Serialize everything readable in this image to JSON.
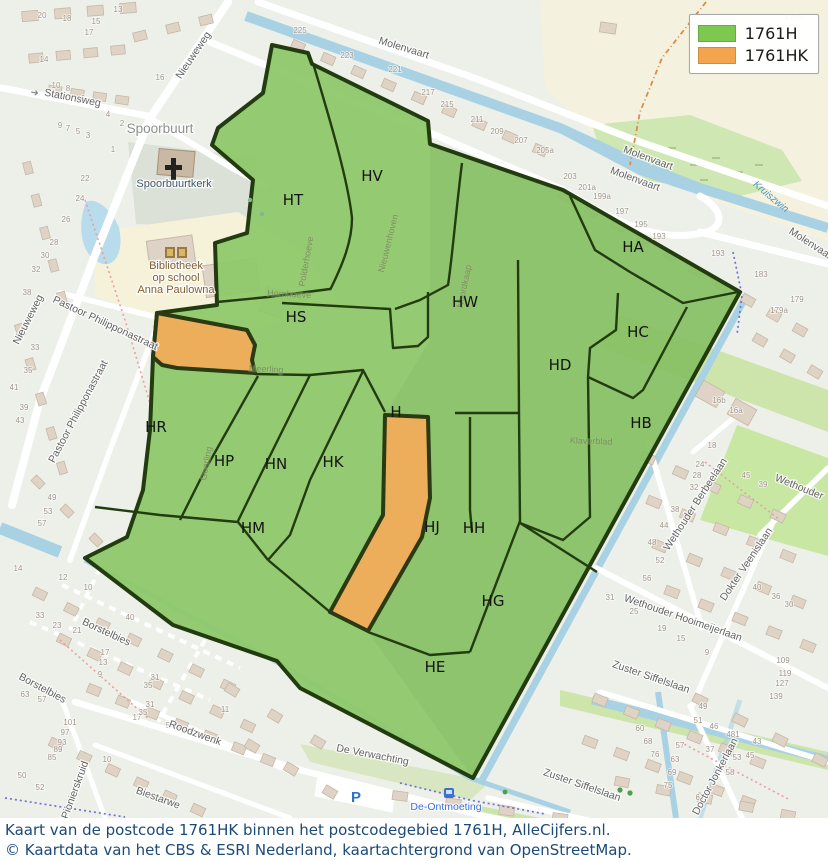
{
  "colors": {
    "area_1761h": "#8dc868",
    "area_1761hk": "#ecae5b",
    "boundary": "#223c10",
    "legend_green": "#7dc850",
    "legend_orange": "#f4a44c",
    "water": "#a8d2e4",
    "caption_text": "#1c4a78"
  },
  "legend": {
    "items": [
      {
        "label": "1761H",
        "color": "#7dc850"
      },
      {
        "label": "1761HK",
        "color": "#f4a44c"
      }
    ]
  },
  "caption": {
    "line1": "Kaart van de postcode 1761HK binnen het postcodegebied 1761H, AlleCijfers.nl.",
    "line2": "© Kaartdata van het CBS & ESRI Nederland, kaartachtergrond van OpenStreetMap."
  },
  "map": {
    "regions": [
      {
        "label": "HT",
        "x": 293,
        "y": 205
      },
      {
        "label": "HV",
        "x": 372,
        "y": 181
      },
      {
        "label": "HA",
        "x": 633,
        "y": 252
      },
      {
        "label": "HS",
        "x": 296,
        "y": 322
      },
      {
        "label": "HW",
        "x": 465,
        "y": 307
      },
      {
        "label": "HC",
        "x": 638,
        "y": 337
      },
      {
        "label": "HD",
        "x": 560,
        "y": 370
      },
      {
        "label": "HB",
        "x": 641,
        "y": 428
      },
      {
        "label": "HR",
        "x": 156,
        "y": 432
      },
      {
        "label": "HP",
        "x": 224,
        "y": 466
      },
      {
        "label": "HN",
        "x": 276,
        "y": 469
      },
      {
        "label": "HK",
        "x": 333,
        "y": 467
      },
      {
        "label": "HM",
        "x": 253,
        "y": 533
      },
      {
        "label": "H",
        "x": 396,
        "y": 417
      },
      {
        "label": "HJ",
        "x": 432,
        "y": 532
      },
      {
        "label": "HH",
        "x": 474,
        "y": 533
      },
      {
        "label": "HG",
        "x": 493,
        "y": 606
      },
      {
        "label": "HE",
        "x": 435,
        "y": 672
      }
    ],
    "streets": [
      {
        "label": "Nieuweweg",
        "x": 196,
        "y": 57,
        "rot": -56
      },
      {
        "label": "Stationsweg",
        "x": 72,
        "y": 101,
        "rot": 11
      },
      {
        "label": "Molenvaart",
        "x": 403,
        "y": 51,
        "rot": 17
      },
      {
        "label": "Molenvaart",
        "x": 647,
        "y": 161,
        "rot": 20
      },
      {
        "label": "Molenvaart",
        "x": 634,
        "y": 182,
        "rot": 20
      },
      {
        "label": "Molenvaart",
        "x": 810,
        "y": 247,
        "rot": 33
      },
      {
        "label": "Nieuweweg",
        "x": 31,
        "y": 321,
        "rot": -63
      },
      {
        "label": "Pastoor Philipponastraat",
        "x": 104,
        "y": 326,
        "rot": 25
      },
      {
        "label": "Pastoor Philipponastraat",
        "x": 81,
        "y": 413,
        "rot": -62
      },
      {
        "label": "Wethouder Berbeelaan",
        "x": 698,
        "y": 506,
        "rot": -57
      },
      {
        "label": "Wethouder",
        "x": 798,
        "y": 490,
        "rot": 22
      },
      {
        "label": "Dokter Veenislaan",
        "x": 749,
        "y": 566,
        "rot": -56
      },
      {
        "label": "Wethouder Hooimeijerlaan",
        "x": 682,
        "y": 621,
        "rot": 19
      },
      {
        "label": "Zuster Siffelslaan",
        "x": 650,
        "y": 680,
        "rot": 19
      },
      {
        "label": "Zuster Siffelslaan",
        "x": 581,
        "y": 788,
        "rot": 19
      },
      {
        "label": "Doctor Jonkerlaan",
        "x": 718,
        "y": 778,
        "rot": -62
      },
      {
        "label": "De Verwachting",
        "x": 372,
        "y": 758,
        "rot": 11
      },
      {
        "label": "Borstelbies",
        "x": 105,
        "y": 635,
        "rot": 25
      },
      {
        "label": "Borstelbies",
        "x": 41,
        "y": 691,
        "rot": 28
      },
      {
        "label": "Roodzwenk",
        "x": 194,
        "y": 736,
        "rot": 20
      },
      {
        "label": "Pionierskruid",
        "x": 78,
        "y": 791,
        "rot": -70
      },
      {
        "label": "Biestarwe",
        "x": 157,
        "y": 801,
        "rot": 20
      }
    ],
    "inner_streets": [
      {
        "label": "Polderhoeve",
        "x": 309,
        "y": 262,
        "rot": -80
      },
      {
        "label": "Nieuwenhoven",
        "x": 391,
        "y": 244,
        "rot": -76
      },
      {
        "label": "Hornhoeve",
        "x": 289,
        "y": 297,
        "rot": 3
      },
      {
        "label": "Meerling",
        "x": 266,
        "y": 372,
        "rot": 3
      },
      {
        "label": "Geerling",
        "x": 209,
        "y": 464,
        "rot": -80
      },
      {
        "label": "Noordkaap",
        "x": 467,
        "y": 287,
        "rot": -78
      },
      {
        "label": "Klaverblad",
        "x": 591,
        "y": 444,
        "rot": 2
      }
    ],
    "places": [
      {
        "label": "Spoorbuurt",
        "x": 160,
        "y": 133,
        "rot": 0,
        "kind": "locality"
      },
      {
        "label": "Spoorbuurtkerk",
        "x": 174,
        "y": 187,
        "rot": 0,
        "kind": "church"
      },
      {
        "label": "Bibliotheek",
        "x": 176,
        "y": 269,
        "rot": 0,
        "kind": "library"
      },
      {
        "label": "op school",
        "x": 176,
        "y": 281,
        "rot": 0,
        "kind": "library"
      },
      {
        "label": "Anna Paulowna",
        "x": 176,
        "y": 293,
        "rot": 0,
        "kind": "library"
      },
      {
        "label": "De-Ontmoeting",
        "x": 446,
        "y": 810,
        "rot": 0,
        "kind": "transit"
      },
      {
        "label": "Kruiszwin",
        "x": 769,
        "y": 199,
        "rot": 40,
        "kind": "water"
      }
    ],
    "poi": {
      "parking": "P"
    },
    "house_numbers": [
      [
        "20",
        42,
        18
      ],
      [
        "18",
        67,
        21
      ],
      [
        "15",
        96,
        24
      ],
      [
        "17",
        89,
        35
      ],
      [
        "13",
        118,
        12
      ],
      [
        "14",
        44,
        62
      ],
      [
        "16",
        160,
        80
      ],
      [
        "10",
        56,
        88
      ],
      [
        "8",
        68,
        91
      ],
      [
        "6",
        83,
        101
      ],
      [
        "4",
        108,
        117
      ],
      [
        "2",
        122,
        126
      ],
      [
        "9",
        60,
        128
      ],
      [
        "7",
        68,
        131
      ],
      [
        "5",
        78,
        134
      ],
      [
        "3",
        88,
        138
      ],
      [
        "1",
        113,
        152
      ],
      [
        "22",
        85,
        181
      ],
      [
        "24",
        80,
        201
      ],
      [
        "26",
        66,
        222
      ],
      [
        "28",
        54,
        245
      ],
      [
        "30",
        45,
        258
      ],
      [
        "32",
        36,
        272
      ],
      [
        "38",
        27,
        295
      ],
      [
        "33",
        35,
        350
      ],
      [
        "35",
        28,
        373
      ],
      [
        "41",
        14,
        390
      ],
      [
        "39",
        24,
        410
      ],
      [
        "43",
        20,
        423
      ],
      [
        "49",
        52,
        500
      ],
      [
        "53",
        48,
        514
      ],
      [
        "57",
        42,
        526
      ],
      [
        "225",
        300,
        33
      ],
      [
        "223",
        347,
        58
      ],
      [
        "221",
        395,
        72
      ],
      [
        "217",
        428,
        95
      ],
      [
        "215",
        447,
        107
      ],
      [
        "211",
        477,
        122
      ],
      [
        "209",
        497,
        134
      ],
      [
        "207",
        521,
        143
      ],
      [
        "205a",
        545,
        153
      ],
      [
        "138b",
        793,
        20
      ],
      [
        "138",
        711,
        43
      ],
      [
        "203",
        570,
        179
      ],
      [
        "201a",
        587,
        190
      ],
      [
        "199a",
        602,
        199
      ],
      [
        "197",
        622,
        214
      ],
      [
        "195",
        641,
        227
      ],
      [
        "193",
        659,
        239
      ],
      [
        "193",
        718,
        256
      ],
      [
        "183",
        761,
        277
      ],
      [
        "179",
        797,
        302
      ],
      [
        "179a",
        779,
        313
      ],
      [
        "16b",
        719,
        403
      ],
      [
        "16a",
        736,
        413
      ],
      [
        "45",
        746,
        478
      ],
      [
        "39",
        763,
        487
      ],
      [
        "18",
        712,
        448
      ],
      [
        "24",
        700,
        467
      ],
      [
        "28",
        697,
        478
      ],
      [
        "32",
        694,
        490
      ],
      [
        "38",
        675,
        512
      ],
      [
        "44",
        664,
        528
      ],
      [
        "48",
        652,
        545
      ],
      [
        "52",
        660,
        563
      ],
      [
        "56",
        647,
        581
      ],
      [
        "31",
        610,
        600
      ],
      [
        "25",
        634,
        614
      ],
      [
        "19",
        662,
        631
      ],
      [
        "15",
        681,
        641
      ],
      [
        "9",
        707,
        655
      ],
      [
        "40",
        757,
        590
      ],
      [
        "36",
        776,
        599
      ],
      [
        "30",
        789,
        607
      ],
      [
        "109",
        783,
        663
      ],
      [
        "119",
        785,
        676
      ],
      [
        "127",
        782,
        686
      ],
      [
        "139",
        776,
        699
      ],
      [
        "37",
        710,
        752
      ],
      [
        "43",
        757,
        744
      ],
      [
        "45",
        750,
        758
      ],
      [
        "40",
        130,
        620
      ],
      [
        "60",
        640,
        731
      ],
      [
        "68",
        648,
        744
      ],
      [
        "76",
        655,
        757
      ],
      [
        "49",
        703,
        709
      ],
      [
        "51",
        698,
        723
      ],
      [
        "46",
        714,
        729
      ],
      [
        "481",
        733,
        737
      ],
      [
        "57",
        680,
        748
      ],
      [
        "63",
        675,
        762
      ],
      [
        "69",
        672,
        775
      ],
      [
        "75",
        668,
        788
      ],
      [
        "66",
        700,
        800
      ],
      [
        "58",
        730,
        775
      ],
      [
        "53",
        737,
        760
      ],
      [
        "14",
        18,
        571
      ],
      [
        "12",
        63,
        580
      ],
      [
        "10",
        88,
        590
      ],
      [
        "33",
        40,
        618
      ],
      [
        "23",
        57,
        628
      ],
      [
        "21",
        77,
        633
      ],
      [
        "17",
        105,
        655
      ],
      [
        "13",
        103,
        665
      ],
      [
        "9",
        100,
        677
      ],
      [
        "63",
        25,
        697
      ],
      [
        "57",
        42,
        702
      ],
      [
        "101",
        70,
        725
      ],
      [
        "97",
        65,
        735
      ],
      [
        "93",
        62,
        745
      ],
      [
        "89",
        58,
        752
      ],
      [
        "85",
        52,
        760
      ],
      [
        "50",
        22,
        778
      ],
      [
        "52",
        40,
        790
      ],
      [
        "31",
        155,
        680
      ],
      [
        "35",
        148,
        688
      ],
      [
        "17",
        137,
        720
      ],
      [
        "5",
        168,
        728
      ],
      [
        "11",
        225,
        712
      ],
      [
        "10",
        107,
        762
      ],
      [
        "31",
        150,
        707
      ],
      [
        "35",
        143,
        715
      ]
    ]
  }
}
